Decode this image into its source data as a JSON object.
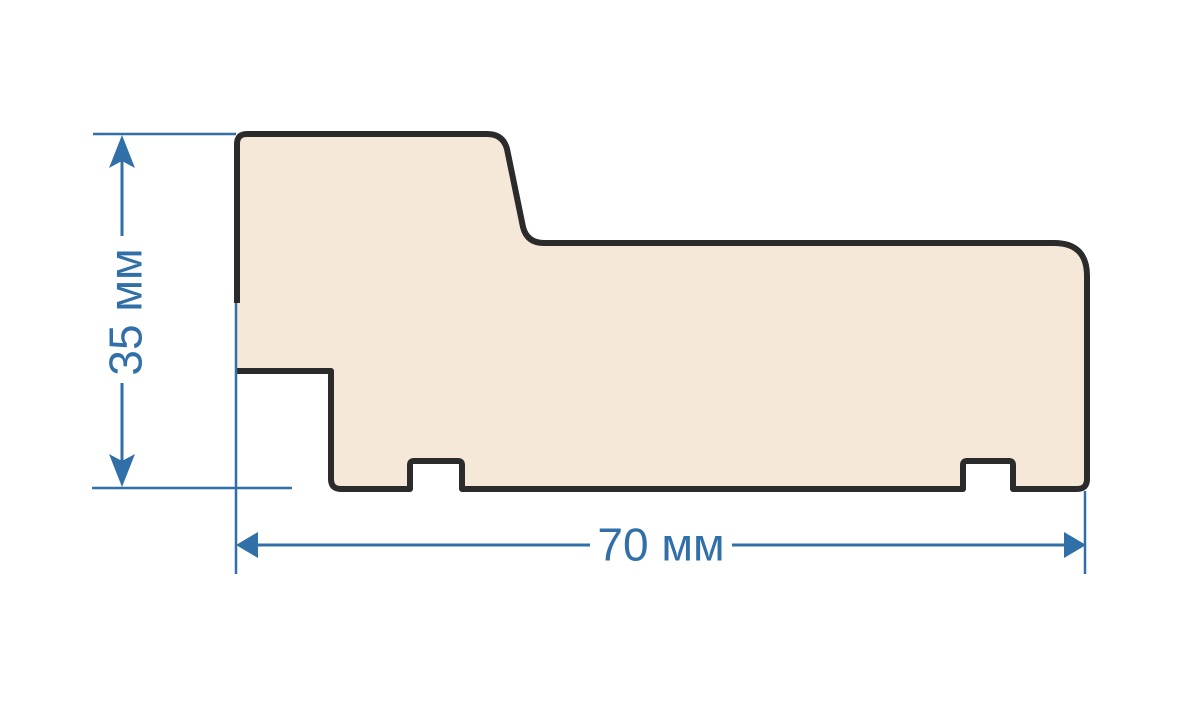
{
  "diagram": {
    "name": "profile-cross-section-drawing",
    "labels": {
      "height": "35 мм",
      "width": "70 мм"
    },
    "dimensions": {
      "height_value": 35,
      "width_value": 70,
      "unit": "мм"
    },
    "colors": {
      "background": "#ffffff",
      "profile_fill": "#f5e8d9",
      "profile_outline": "#2b2b2b",
      "dimension_blue": "#316fa8"
    }
  }
}
